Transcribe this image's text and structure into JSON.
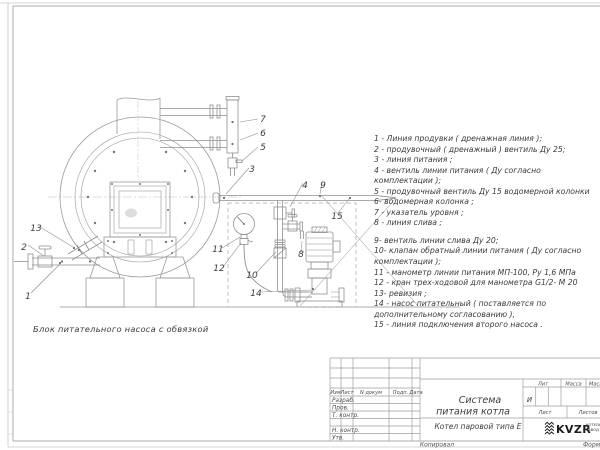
{
  "drawing": {
    "caption": "Блок питательного насоса с обвязкой"
  },
  "legend": {
    "lines": [
      "1 -  Линия продувки  ( дренажная линия );",
      "2 -  продувочный  ( дренажный )  вентиль  Ду 25;",
      "3 -  линия питания ;",
      "4 -  вентиль линии питания  ( Ду согласно",
      "комплектации );",
      "5 -  продувочный вентиль  Ду 15  водомерной колонки",
      "6-  водомерная колонка ;",
      "7 -  указатель уровня ;",
      "8 -  линия слива ;",
      "9-  вентиль линии слива  Ду 20;",
      "10-  клапан обратный линии питания  ( Ду согласно",
      "комплектации );",
      "11 -  манометр линии питания  МП-100,  Ру 1,6  МПа",
      "12 -  кран трех-ходовой для манометра  G1/2- М 20",
      "13-  ревизия ;",
      "14 -  насос питательный  ( поставляется по",
      "дополнительному согласованию ),",
      "15 -  линия подключения второго насоса ."
    ]
  },
  "callouts": [
    "1",
    "2",
    "3",
    "4",
    "5",
    "6",
    "7",
    "8",
    "9",
    "10",
    "11",
    "12",
    "13",
    "14",
    "15"
  ],
  "titleblock": {
    "cols": [
      "Изм",
      "Лист",
      "N докум",
      "Подп.",
      "Дата"
    ],
    "roles": [
      "Разраб.",
      "Пров.",
      "Т. контр.",
      "Н. контр.",
      "Утв."
    ],
    "title_line1": "Система",
    "title_line2": "питания котла",
    "product": "Котел паровой типа Е",
    "lit_label": "Лит",
    "lit_value": "И",
    "mass_label": "Масса",
    "scale_label": "Масш",
    "sheet_label": "Лист",
    "sheets_label": "Листов",
    "logo_text": "KVZR",
    "logo_sub1": "КОТЕЛЬН",
    "logo_sub2": "ЗАВОД Р",
    "copied_label": "Копировал",
    "format_label": "Формат"
  }
}
